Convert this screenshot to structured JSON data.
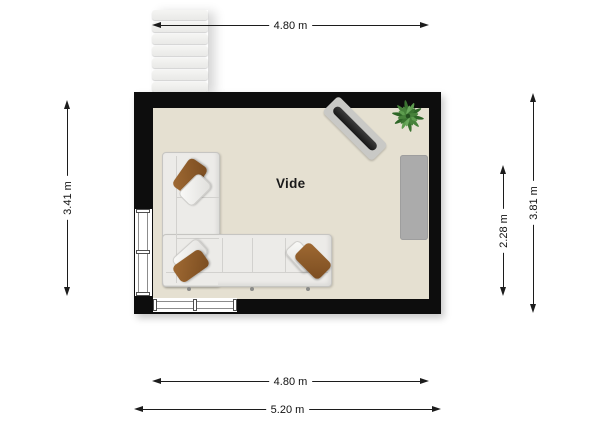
{
  "floorplan": {
    "room": {
      "label": "Vide"
    },
    "dimensions": {
      "top": "4.80 m",
      "left": "3.41 m",
      "right_inner": "2.28 m",
      "right_outer": "3.81 m",
      "bottom_inner": "4.80 m",
      "bottom_outer": "5.20 m"
    },
    "furniture": {
      "staircase": "staircase",
      "sofa": "l-shaped-sectional-sofa",
      "pillows": [
        "brown",
        "white",
        "white",
        "brown",
        "white",
        "brown"
      ],
      "board": "board-on-mat",
      "plant": "potted-plant",
      "sideboard": "sideboard"
    },
    "colors": {
      "wall": "#0d0d0d",
      "floor": "#e5e0d1",
      "sofa": "#ecebe8",
      "pillow_brown": "#7a4c20",
      "plant": "#4f8f46",
      "sideboard": "#ababab",
      "mat": "#c9c9c6",
      "board": "#161616",
      "stairs": "#e9e9e7",
      "dimension_line": "#1c1c1c"
    }
  }
}
